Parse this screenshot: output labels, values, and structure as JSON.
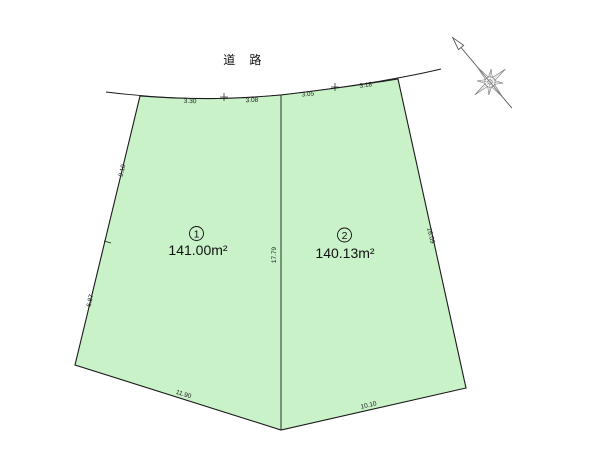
{
  "road": {
    "label": "道 路"
  },
  "parcels": [
    {
      "number": "1",
      "area": "141.00m²"
    },
    {
      "number": "2",
      "area": "140.13m²"
    }
  ],
  "dimensions": {
    "top": [
      "3.30",
      "3.08",
      "3.05",
      "3.18"
    ],
    "left": [
      "9.10",
      "6.87"
    ],
    "divider": "17.79",
    "right": "16.09",
    "bottom_left": "11.90",
    "bottom_right": "10.10"
  },
  "colors": {
    "parcel_fill": "#c9f2c9",
    "line": "#1a1a1a"
  }
}
